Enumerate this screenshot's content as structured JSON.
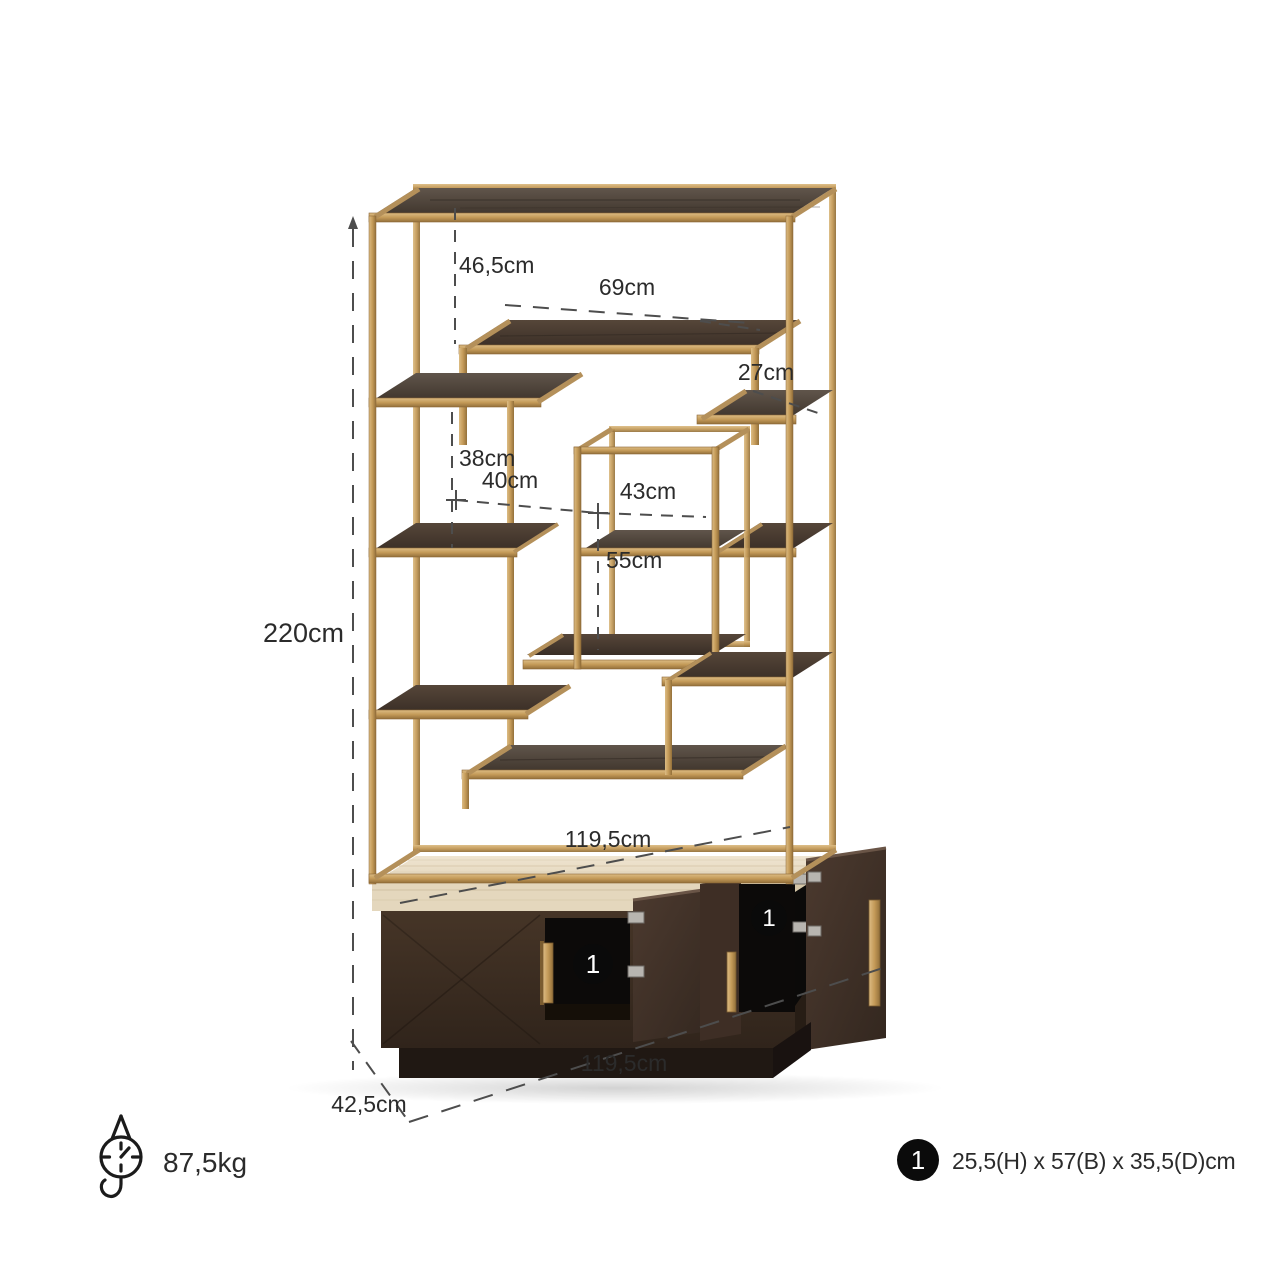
{
  "dimensions": {
    "overall_height": "220cm",
    "top_shelf_gap": "46,5cm",
    "bridge_shelf_width": "69cm",
    "bridge_step_height": "27cm",
    "left_shelf_gap": "38cm",
    "left_shelf_width": "40cm",
    "cube_width": "43cm",
    "cube_height": "55cm",
    "inner_shelf_width": "119,5cm",
    "overall_width": "119,5cm",
    "overall_depth": "42,5cm"
  },
  "weight": {
    "label": "87,5kg"
  },
  "cabinet": {
    "left_compartment_badge": "1",
    "right_compartment_badge": "1"
  },
  "legend": {
    "badge": "1",
    "dimensions_text": "25,5(H) x 57(B) x 35,5(D)cm"
  },
  "icons": {
    "weight_scale": "hanging-scale-icon"
  },
  "colors": {
    "gold_frame": "#C49B5F",
    "dark_wood_shelf": "#4E4238",
    "travertine_top": "#EBDFC8",
    "cabinet_wood": "#3A2B21",
    "interior_black": "#0C0A09",
    "dimension_text": "#2B2B2B",
    "dashed_line": "#4D4D4D",
    "background": "#FFFFFF"
  }
}
